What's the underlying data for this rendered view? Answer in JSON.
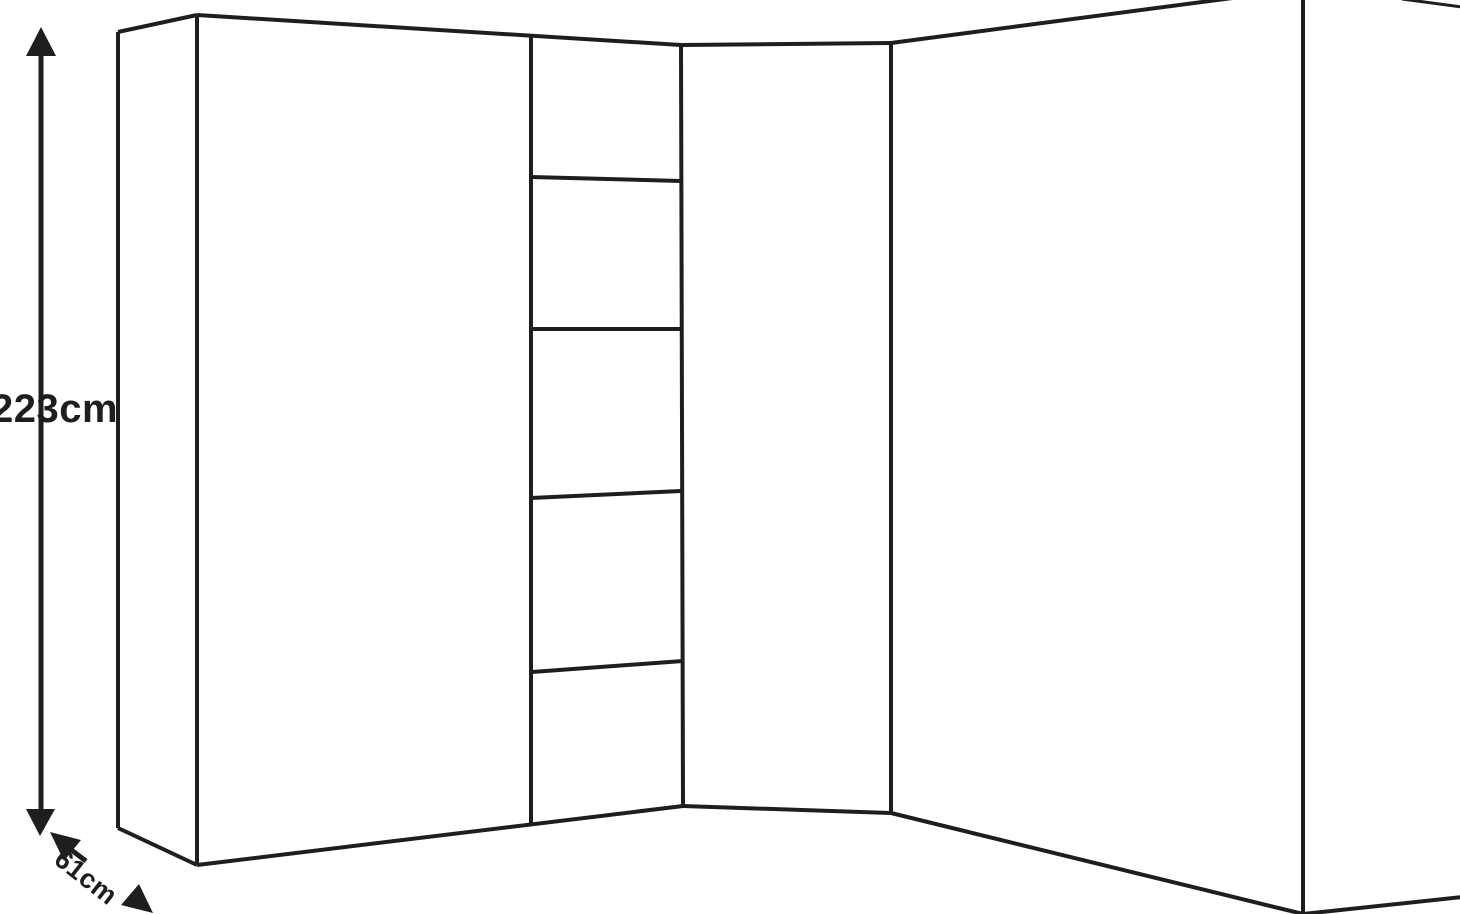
{
  "diagram": {
    "kind": "corner-wardrobe-dimension-line-drawing"
  },
  "dimensions": {
    "height_label": "223cm",
    "depth_label": "61cm"
  },
  "icons": {
    "height_arrow": "double-headed-vertical-arrow-icon",
    "depth_arrow": "double-headed-diagonal-arrow-icon"
  },
  "colors": {
    "line": "#1e1e1e",
    "background": "#ffffff"
  }
}
